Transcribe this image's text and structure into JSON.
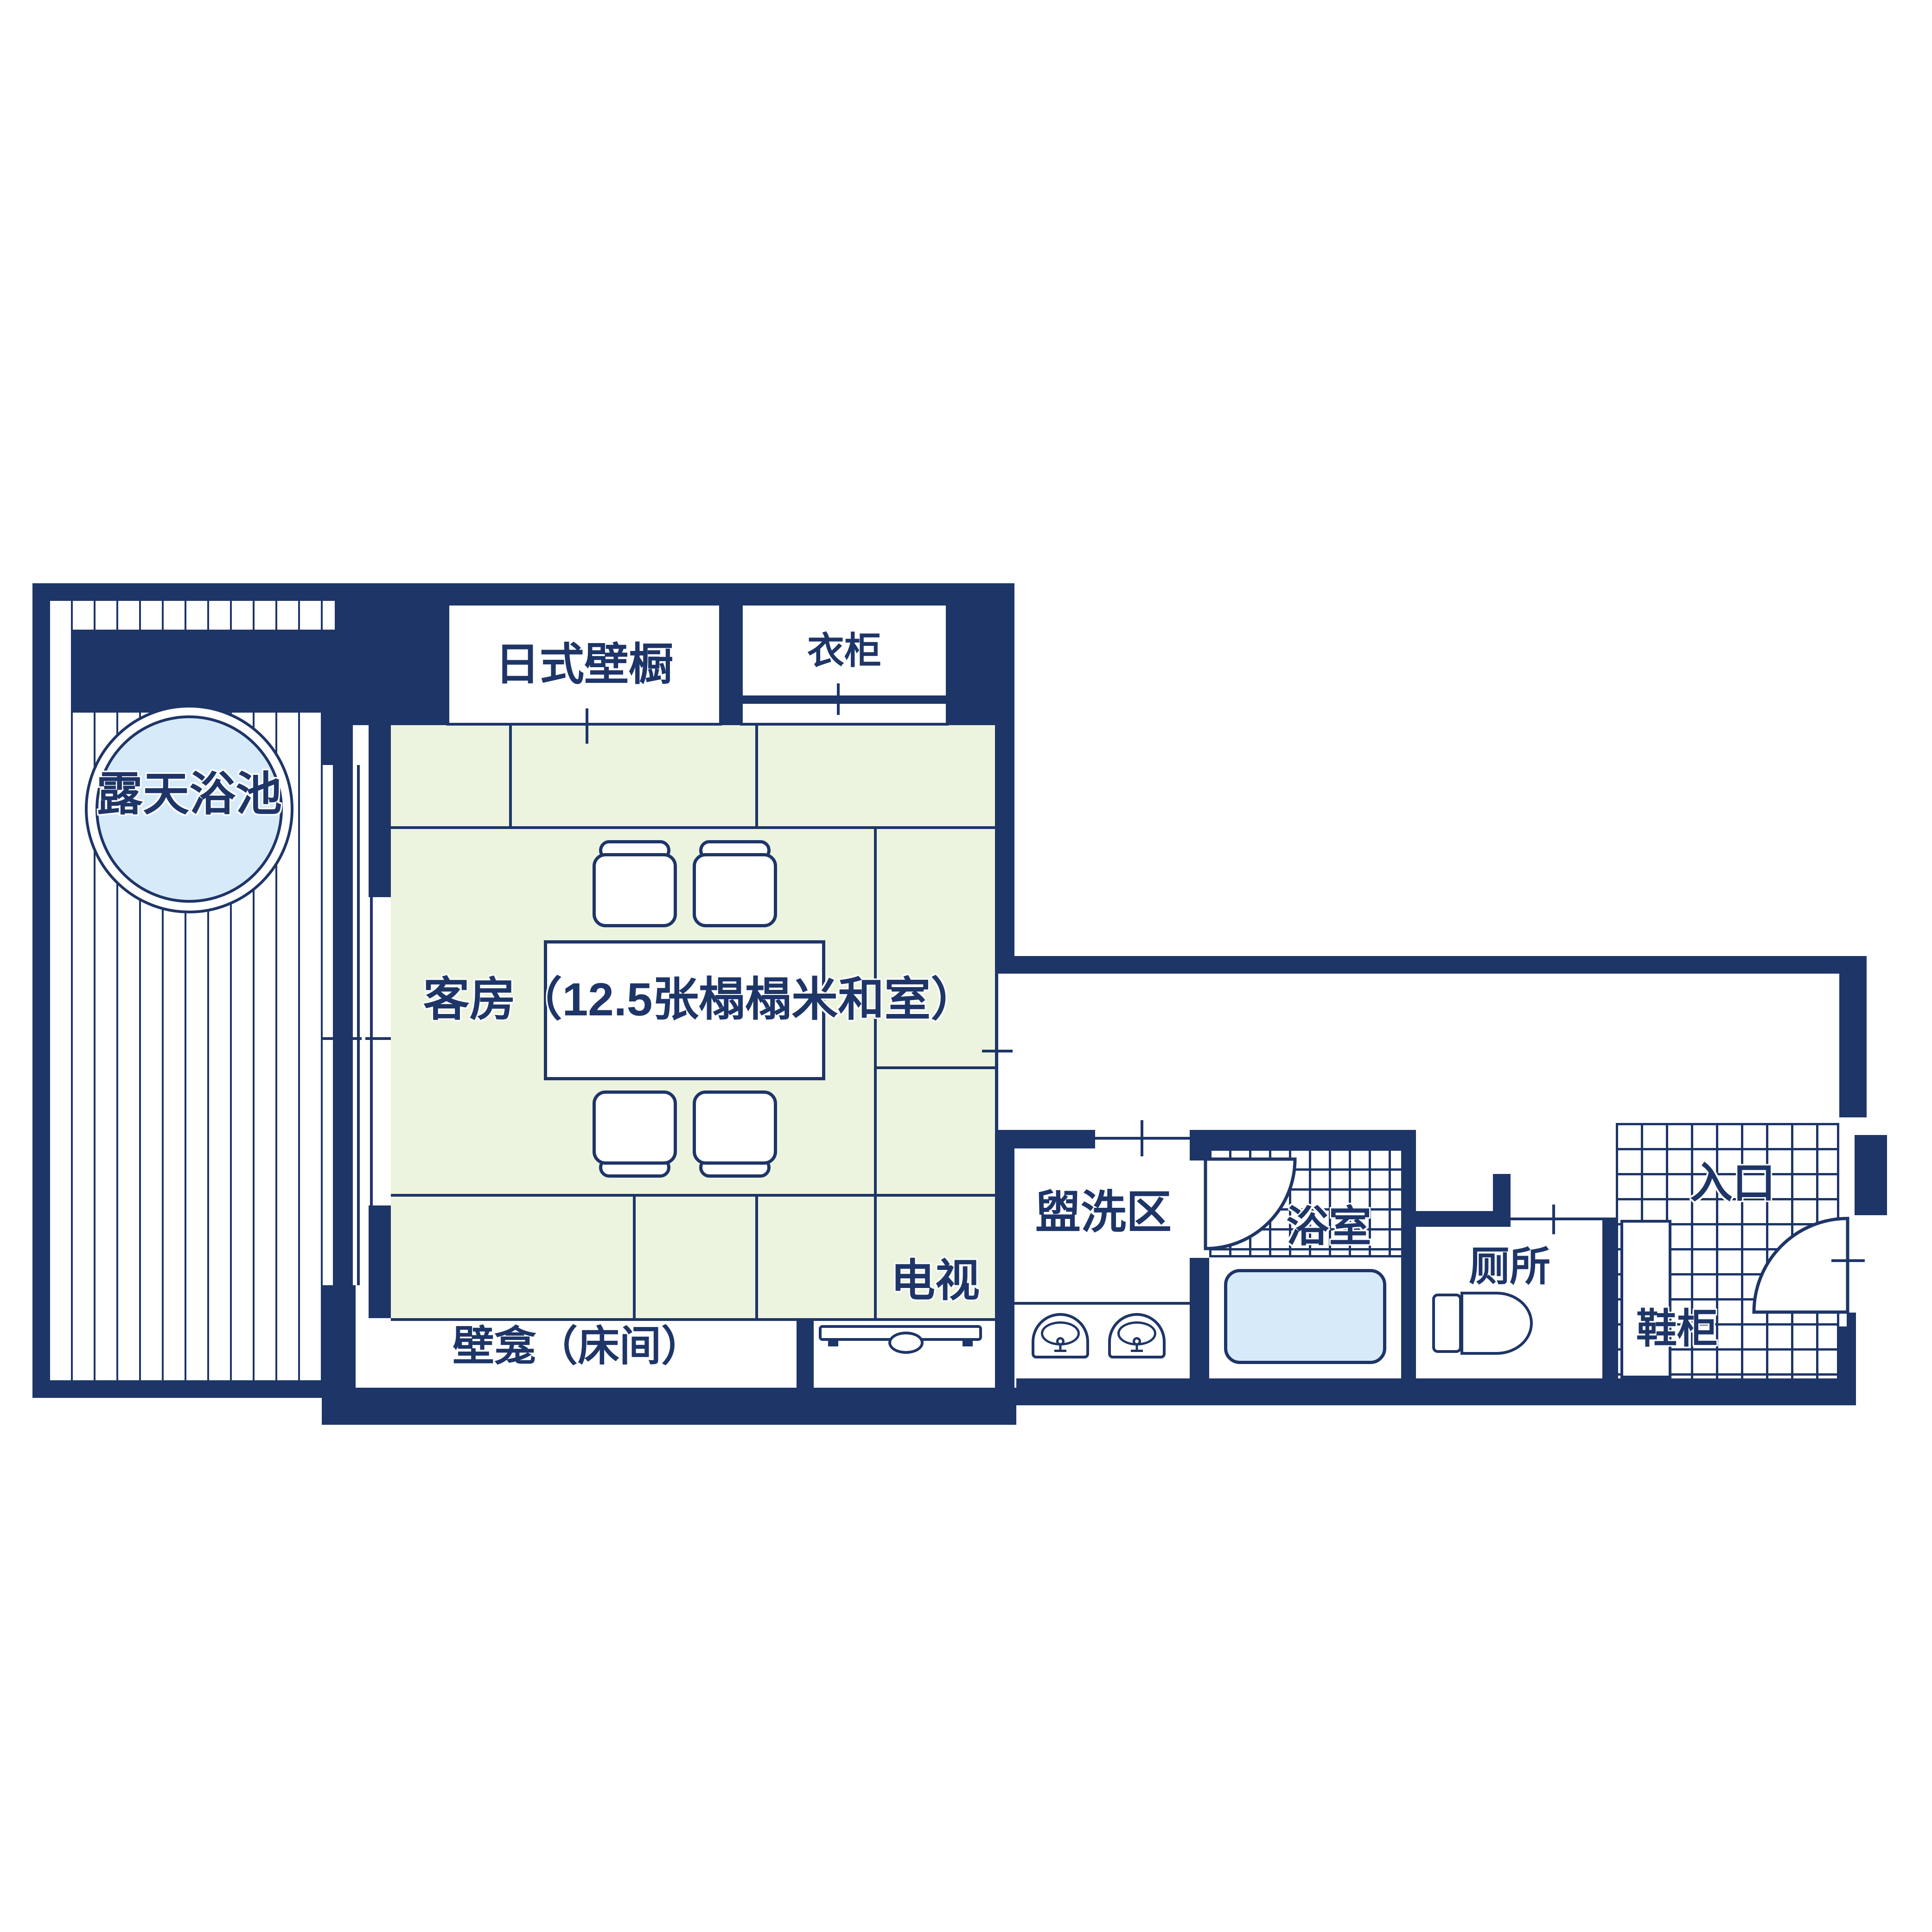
{
  "palette": {
    "navy": "#1e3568",
    "tatami_green": "#ecf4df",
    "water_blue": "#d7eafa",
    "background": "#ffffff"
  },
  "rooms": {
    "open_air_bath": {
      "label": "露天浴池"
    },
    "japanese_closet": {
      "label": "日式壁橱"
    },
    "wardrobe": {
      "label": "衣柜"
    },
    "guest_room": {
      "label": "客房（12.5张榻榻米和室）"
    },
    "tv": {
      "label": "电视"
    },
    "alcove": {
      "label": "壁龛（床间）"
    },
    "washroom": {
      "label": "盥洗区"
    },
    "bathroom": {
      "label": "浴室"
    },
    "toilet": {
      "label": "厕所"
    },
    "shoe_cabinet": {
      "label": "鞋柜"
    },
    "entrance": {
      "label": "入口"
    }
  }
}
